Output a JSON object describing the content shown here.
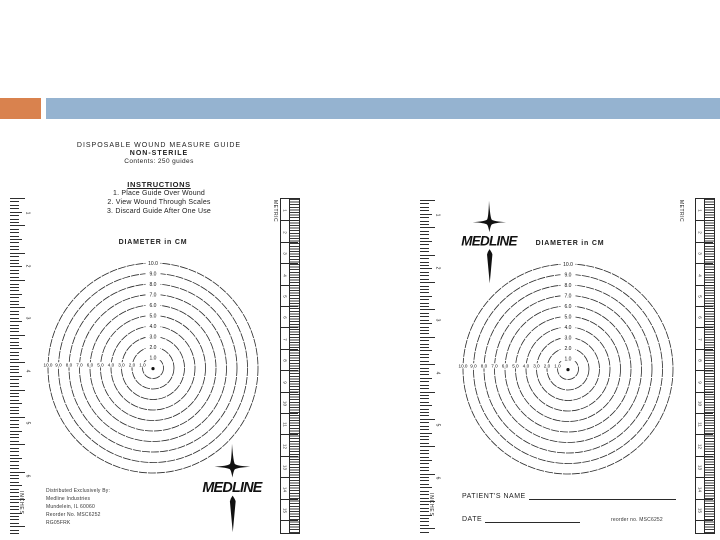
{
  "slide": {
    "accent_orange": "#d9824e",
    "accent_blue": "#95b3d0",
    "ink": "#2a2a2a"
  },
  "left_guide": {
    "heading_line1": "DISPOSABLE WOUND MEASURE GUIDE",
    "heading_line2": "NON-STERILE",
    "heading_line3": "Contents: 250 guides",
    "instructions_title": "INSTRUCTIONS",
    "instructions": [
      "1.  Place Guide Over Wound",
      "2.  View Wound Through Scales",
      "3.  Discard Guide After One Use"
    ],
    "diagram_title": "DIAMETER in CM",
    "distributor": [
      "Distributed Exclusively By:",
      "Medline Industries",
      "Mundelein, IL 60060",
      "Reorder No. MSC6252",
      "RG05FRK"
    ],
    "logo_text": "MEDLINE"
  },
  "right_guide": {
    "logo_text": "MEDLINE",
    "diagram_title": "DIAMETER in CM",
    "patient_label": "PATIENT'S NAME",
    "date_label": "DATE",
    "reorder_note": "reorder no. MSC6252"
  },
  "diagram": {
    "type": "concentric-circles",
    "units": "cm",
    "title": "DIAMETER in CM",
    "diameters_cm": [
      1.0,
      2.0,
      3.0,
      4.0,
      5.0,
      6.0,
      7.0,
      8.0,
      9.0,
      10.0
    ],
    "vertical_ring_labels": [
      "10.0",
      "9.0",
      "8.0",
      "7.0",
      "6.0",
      "5.0",
      "4.0",
      "3.0",
      "2.0",
      "1.0"
    ],
    "horizontal_axis_labels": [
      "10.0",
      "9.0",
      "8.0",
      "7.0",
      "6.0",
      "5.0",
      "4.0",
      "3.0",
      "2.0",
      "1.0"
    ],
    "center_marker": "dot"
  },
  "rulers": {
    "metric_label": "METRIC",
    "metric_numbers": [
      1,
      2,
      3,
      4,
      5,
      6,
      7,
      8,
      9,
      10,
      11,
      12,
      13,
      14,
      15
    ],
    "inches_label": "INCHES",
    "inches_numbers": [
      1,
      2,
      3,
      4,
      5,
      6
    ]
  }
}
